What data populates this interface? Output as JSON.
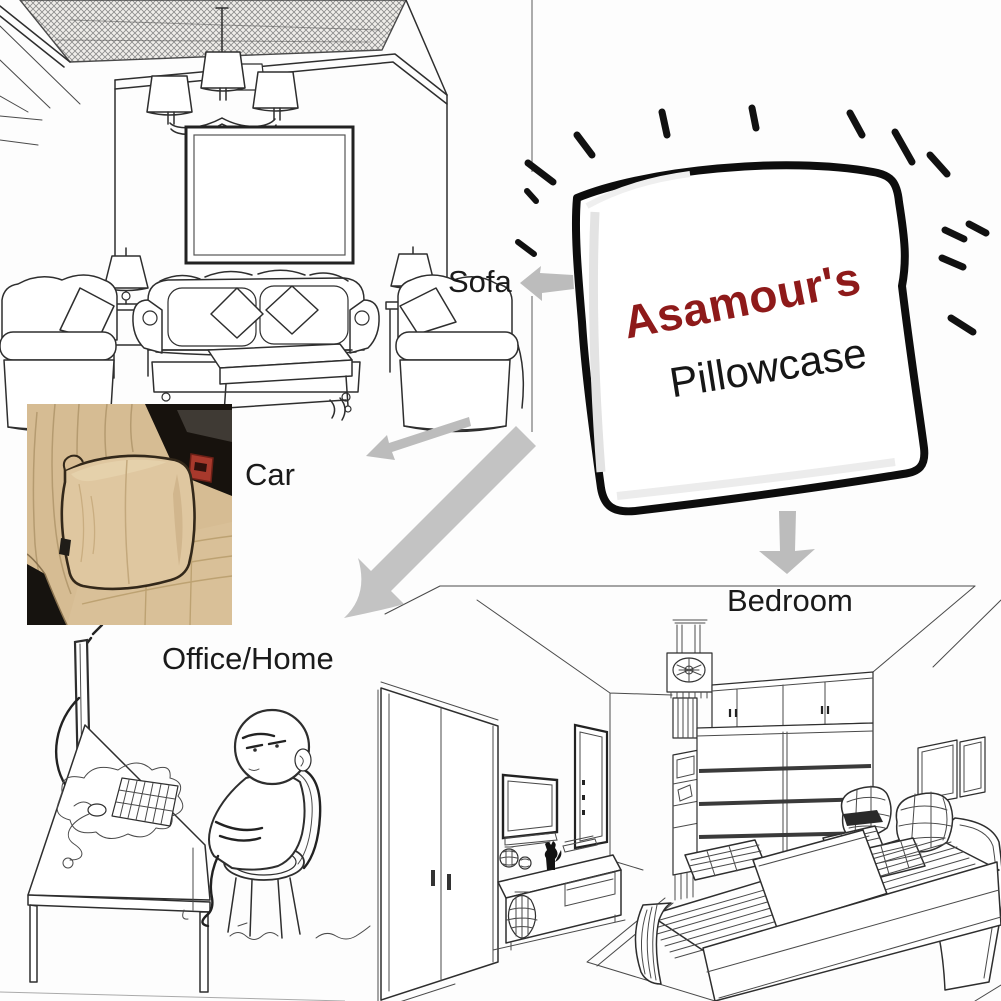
{
  "product": {
    "brand": "Asamour's",
    "name": "Pillowcase"
  },
  "scene_labels": {
    "sofa": "Sofa",
    "car": "Car",
    "office": "Office/Home",
    "bedroom": "Bedroom"
  },
  "colors": {
    "brand_text": "#8e1a1a",
    "product_text": "#161616",
    "label_text": "#1a1a1a",
    "arrow_gray": "#bcbcbc",
    "line_art": "#2e2e2e",
    "background": "#fdfdfd",
    "car_seat_beige": "#d6bc93",
    "car_pillow_beige": "#dfc7a0",
    "car_piping_brown": "#33281a",
    "car_interior_dark": "#17120d",
    "car_buckle_red": "#a8392c"
  }
}
